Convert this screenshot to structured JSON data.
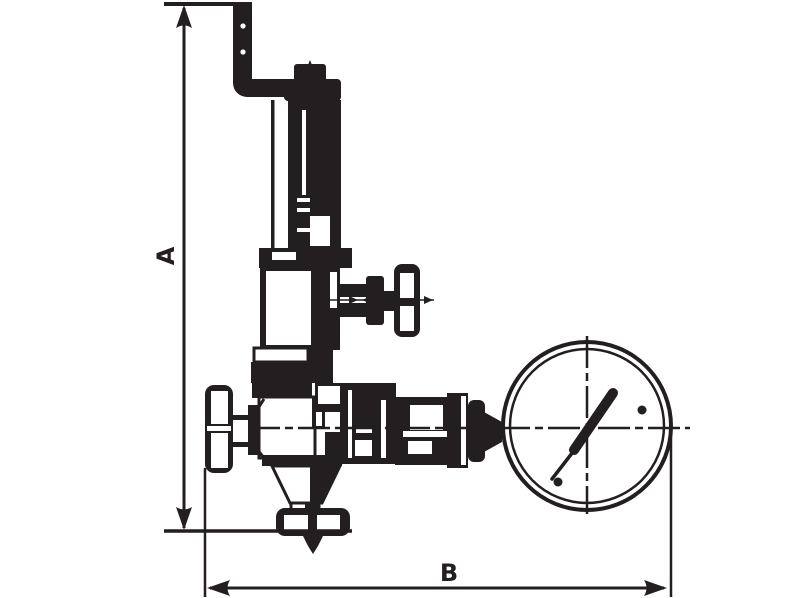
{
  "drawing": {
    "title": "Pressure relief valve with gauge — dimensional outline drawing",
    "line_color": "#231f20",
    "background_color": "#ffffff",
    "components": [
      "z-shaped-outlet-pipe",
      "spring-housing",
      "bonnet",
      "side-handwheel-valve",
      "valve-body",
      "inlet-handwheel",
      "bottom-outlet-flange",
      "gauge-union-coupling",
      "pressure-gauge"
    ]
  },
  "dimensions": {
    "a": {
      "label": "A",
      "orientation": "vertical"
    },
    "b": {
      "label": "B",
      "orientation": "horizontal"
    }
  }
}
